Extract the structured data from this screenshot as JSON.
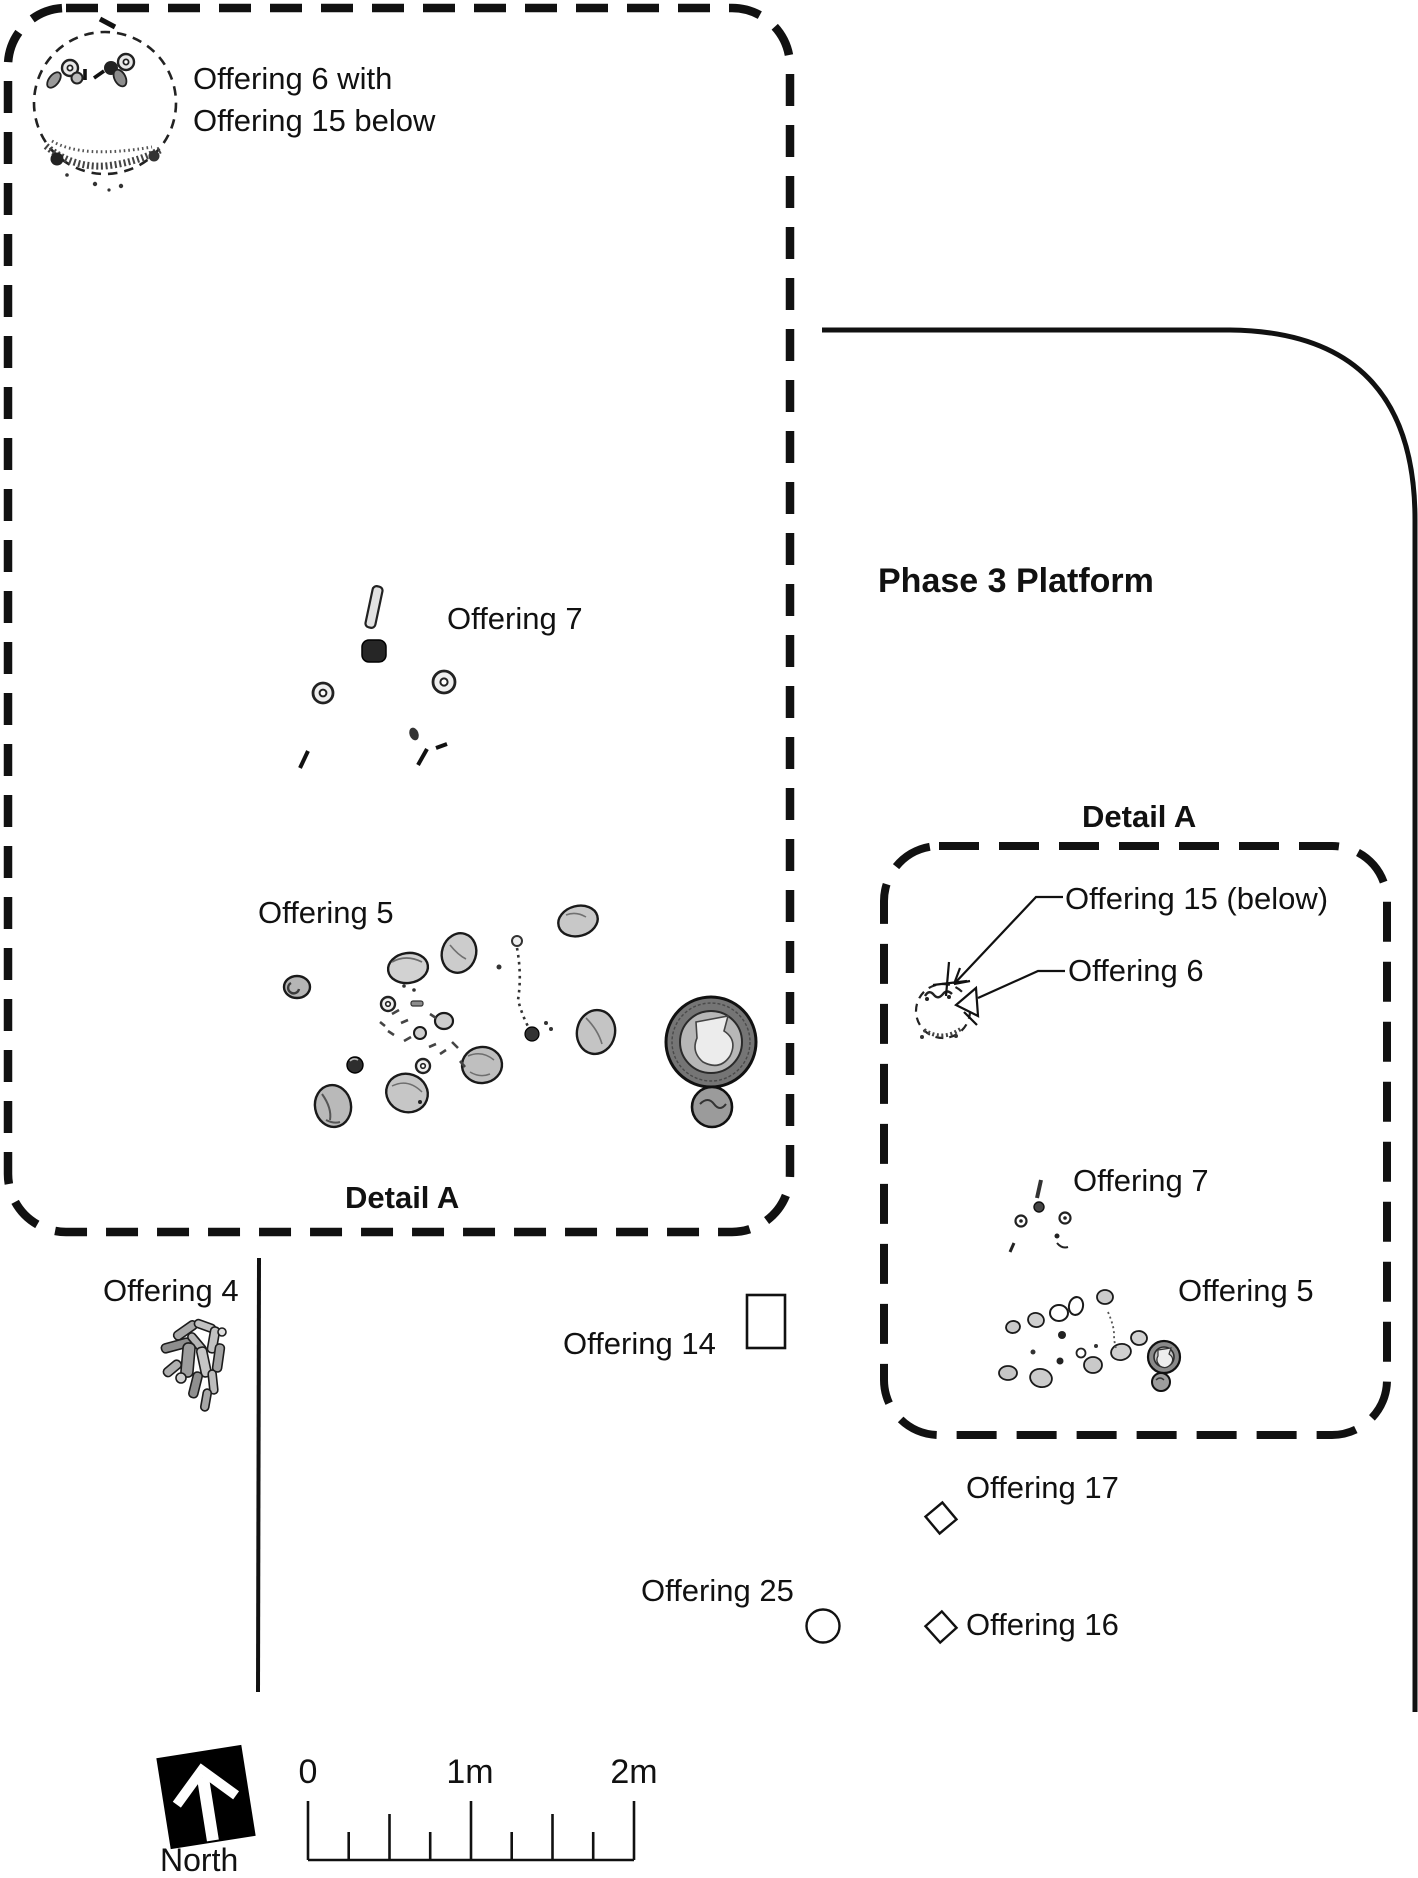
{
  "figure": {
    "title_area": "Phase 3 Platform excavation plan",
    "colors": {
      "ink": "#111111",
      "background": "#ffffff",
      "stone_fill": "#c9c9c9",
      "dark_artifact": "#2a2a2a"
    }
  },
  "labels": {
    "offering_6_with": "Offering 6 with",
    "offering_15_below_line": "Offering 15 below",
    "offering_7_left": "Offering 7",
    "offering_5_left": "Offering 5",
    "detail_a_left": "Detail A",
    "phase_3_platform": "Phase 3 Platform",
    "detail_a_right": "Detail A",
    "offering_15_callout": "Offering 15 (below)",
    "offering_6_callout": "Offering 6",
    "offering_7_right": "Offering 7",
    "offering_5_right": "Offering 5",
    "offering_4": "Offering 4",
    "offering_14": "Offering 14",
    "offering_17": "Offering 17",
    "offering_25": "Offering 25",
    "offering_16": "Offering 16",
    "north": "North"
  },
  "scale_bar": {
    "tick_0": "0",
    "tick_1m": "1m",
    "tick_2m": "2m"
  }
}
